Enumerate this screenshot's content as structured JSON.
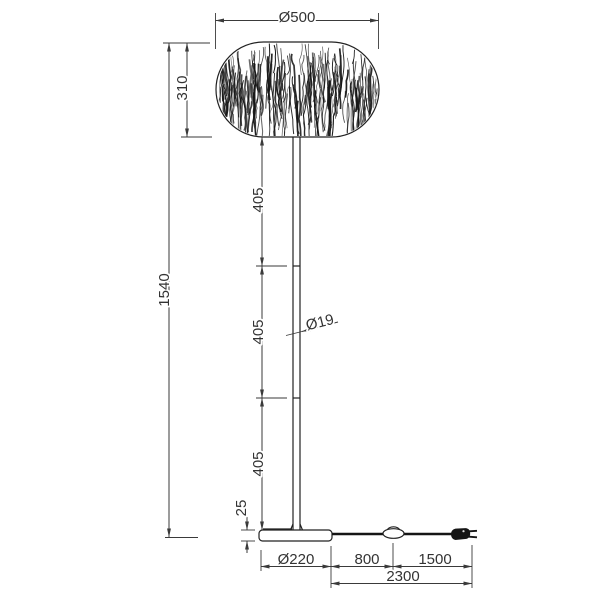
{
  "drawing": {
    "subject": "floor lamp elevation with dimensions",
    "colors": {
      "line": "#3a3a3a",
      "object": "#222222",
      "cord": "#151515",
      "background": "#ffffff"
    },
    "labels": {
      "shade_diameter": "Ø500",
      "shade_height": "310",
      "total_height": "1540",
      "pole_segment_upper": "405",
      "pole_segment_middle": "405",
      "pole_segment_lower": "405",
      "pole_diameter": "Ø19",
      "base_height": "25",
      "base_diameter": "Ø220",
      "base_to_switch": "800",
      "switch_to_plug": "1500",
      "cord_overall": "2300"
    }
  }
}
